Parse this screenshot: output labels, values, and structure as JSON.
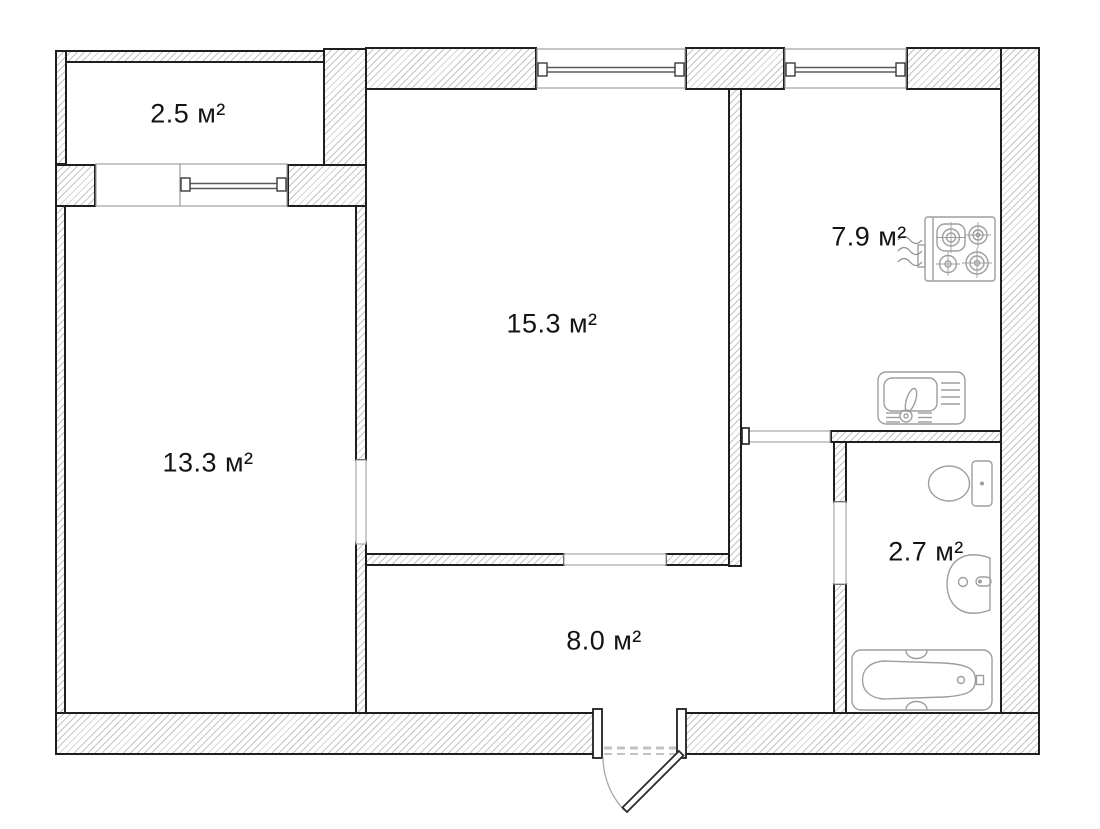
{
  "plan": {
    "background_color": "#ffffff",
    "wall_outline_color": "#1f1f1f",
    "wall_hatch_color": "#c4c4c4",
    "opening_line_color": "#a0a0a0",
    "fixture_line_color": "#9e9e9e",
    "label_color": "#141414",
    "rooms": [
      {
        "id": "balcony",
        "area": "2.5 м²"
      },
      {
        "id": "room-left",
        "area": "13.3 м²"
      },
      {
        "id": "room-center",
        "area": "15.3 м²"
      },
      {
        "id": "kitchen",
        "area": "7.9 м²"
      },
      {
        "id": "bathroom",
        "area": "2.7 м²"
      },
      {
        "id": "hallway",
        "area": "8.0 м²"
      }
    ],
    "icons": [
      "gas-stove-icon",
      "kitchen-sink-icon",
      "toilet-icon",
      "bathroom-sink-icon",
      "bathtub-icon",
      "entrance-door-icon",
      "window-icon"
    ]
  }
}
